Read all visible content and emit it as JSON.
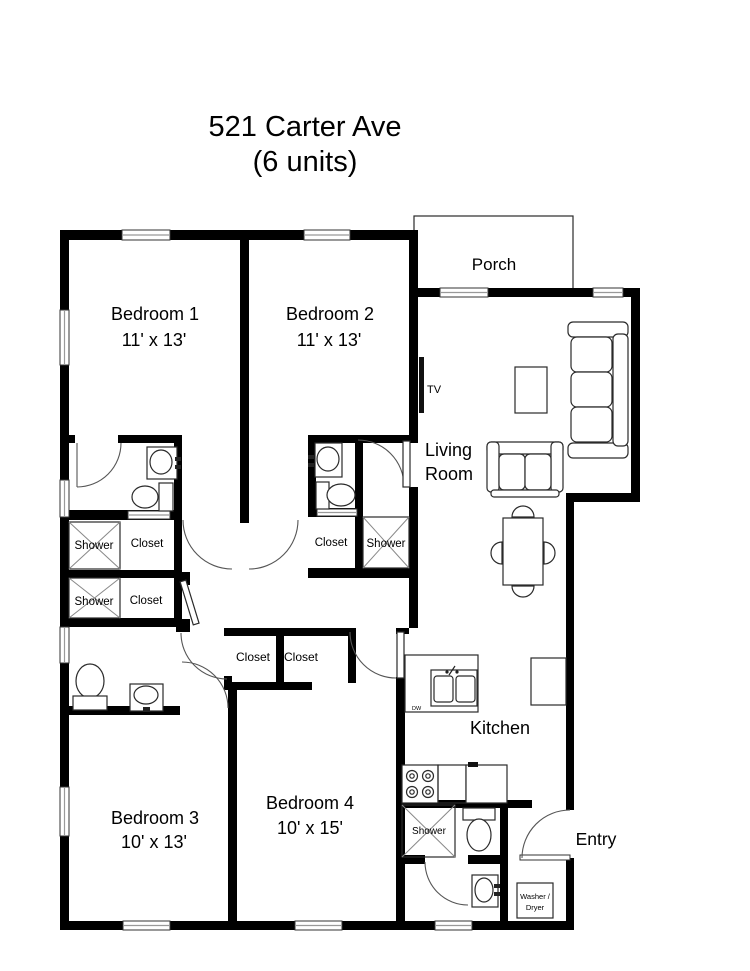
{
  "title": {
    "line1": "521 Carter Ave",
    "line2": "(6 units)"
  },
  "rooms": {
    "porch": {
      "label": "Porch"
    },
    "bedroom1": {
      "label": "Bedroom 1",
      "dims": "11' x 13'"
    },
    "bedroom2": {
      "label": "Bedroom 2",
      "dims": "11' x 13'"
    },
    "bedroom3": {
      "label": "Bedroom 3",
      "dims": "10' x 13'"
    },
    "bedroom4": {
      "label": "Bedroom 4",
      "dims": "10' x 15'"
    },
    "living_room": {
      "line1": "Living",
      "line2": "Room"
    },
    "kitchen": {
      "label": "Kitchen"
    },
    "entry": {
      "label": "Entry"
    }
  },
  "fixtures": {
    "shower_label": "Shower",
    "closet_label": "Closet",
    "tv_label": "TV",
    "dishwasher_label": "DW",
    "washer_dryer": {
      "line1": "Washer /",
      "line2": "Dryer"
    }
  },
  "colors": {
    "wall": "#000000",
    "background": "#ffffff",
    "thin_line": "#2a2a2a"
  }
}
